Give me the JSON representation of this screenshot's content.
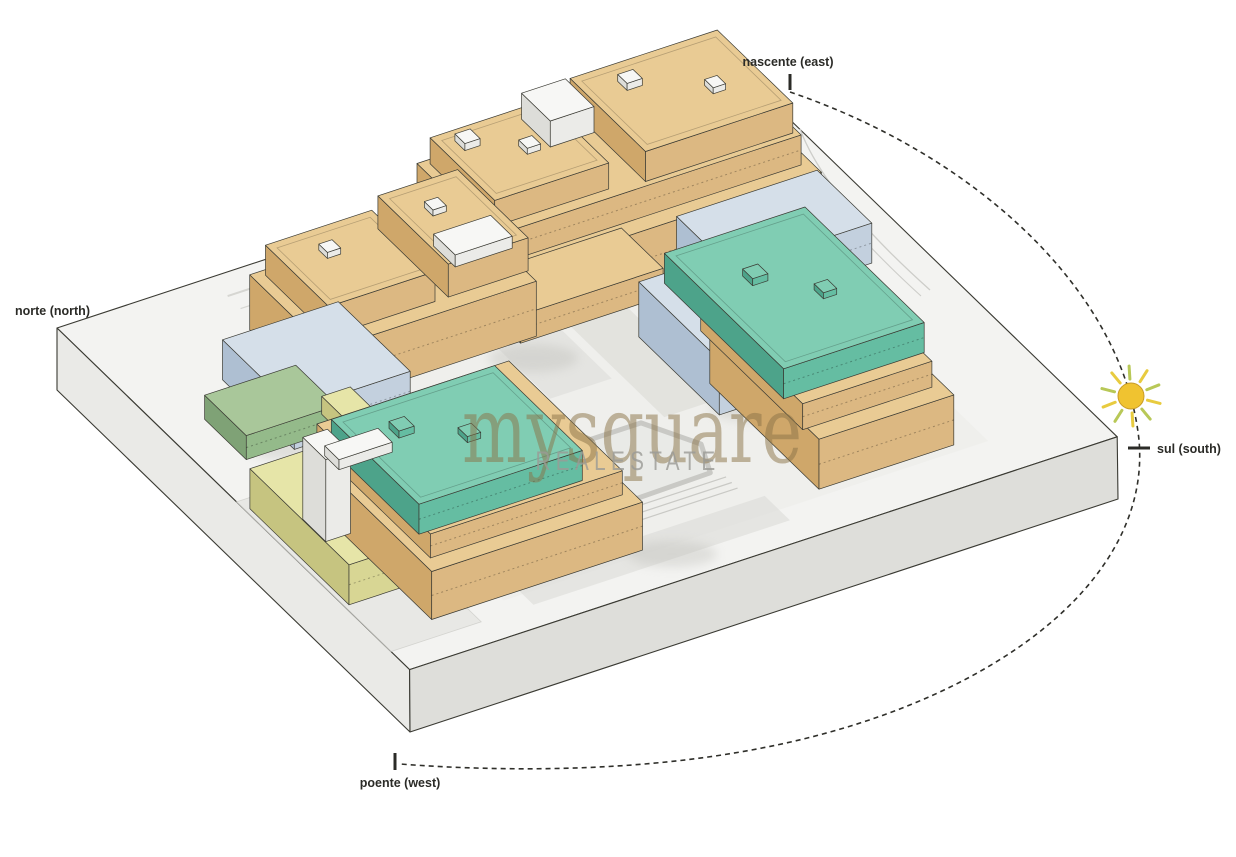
{
  "diagram": {
    "title": "site orientation diagram",
    "compass": {
      "east": "nascente (east)",
      "north": "norte (north)",
      "south": "sul (south)",
      "west": "poente (west)"
    },
    "watermark": {
      "brand": "mysquare",
      "subtitle": "REALESTATE"
    }
  },
  "materials": {
    "tan": {
      "top": "#e9cb94",
      "left": "#cfa76a",
      "right": "#dcb882"
    },
    "blue": {
      "top": "#d5dfe9",
      "left": "#aebfd2",
      "right": "#c3d0de"
    },
    "teal": {
      "top": "#80cdb3",
      "left": "#4da38a",
      "right": "#65bda2"
    },
    "green": {
      "top": "#a9c79a",
      "left": "#7fa276",
      "right": "#94ba8a"
    },
    "yellow": {
      "top": "#e6e5a8",
      "left": "#c6c480",
      "right": "#d8d694"
    },
    "white": {
      "top": "#f7f7f5",
      "left": "#ddddd9",
      "right": "#ebebe8"
    },
    "platform": {
      "top": "#f3f3f1",
      "left": "#eaeae7",
      "right": "#dededa"
    },
    "outline": "#3a3a33",
    "sun_fill": "#f0c330",
    "sun_ray_yellow": "#e8cb3f",
    "sun_ray_green": "#b8c857",
    "arc_color": "#2f2f2a",
    "label_color": "#2b2b27",
    "watermark_brand_color": "#8a7347",
    "watermark_subtitle_color": "#9b9b96"
  }
}
